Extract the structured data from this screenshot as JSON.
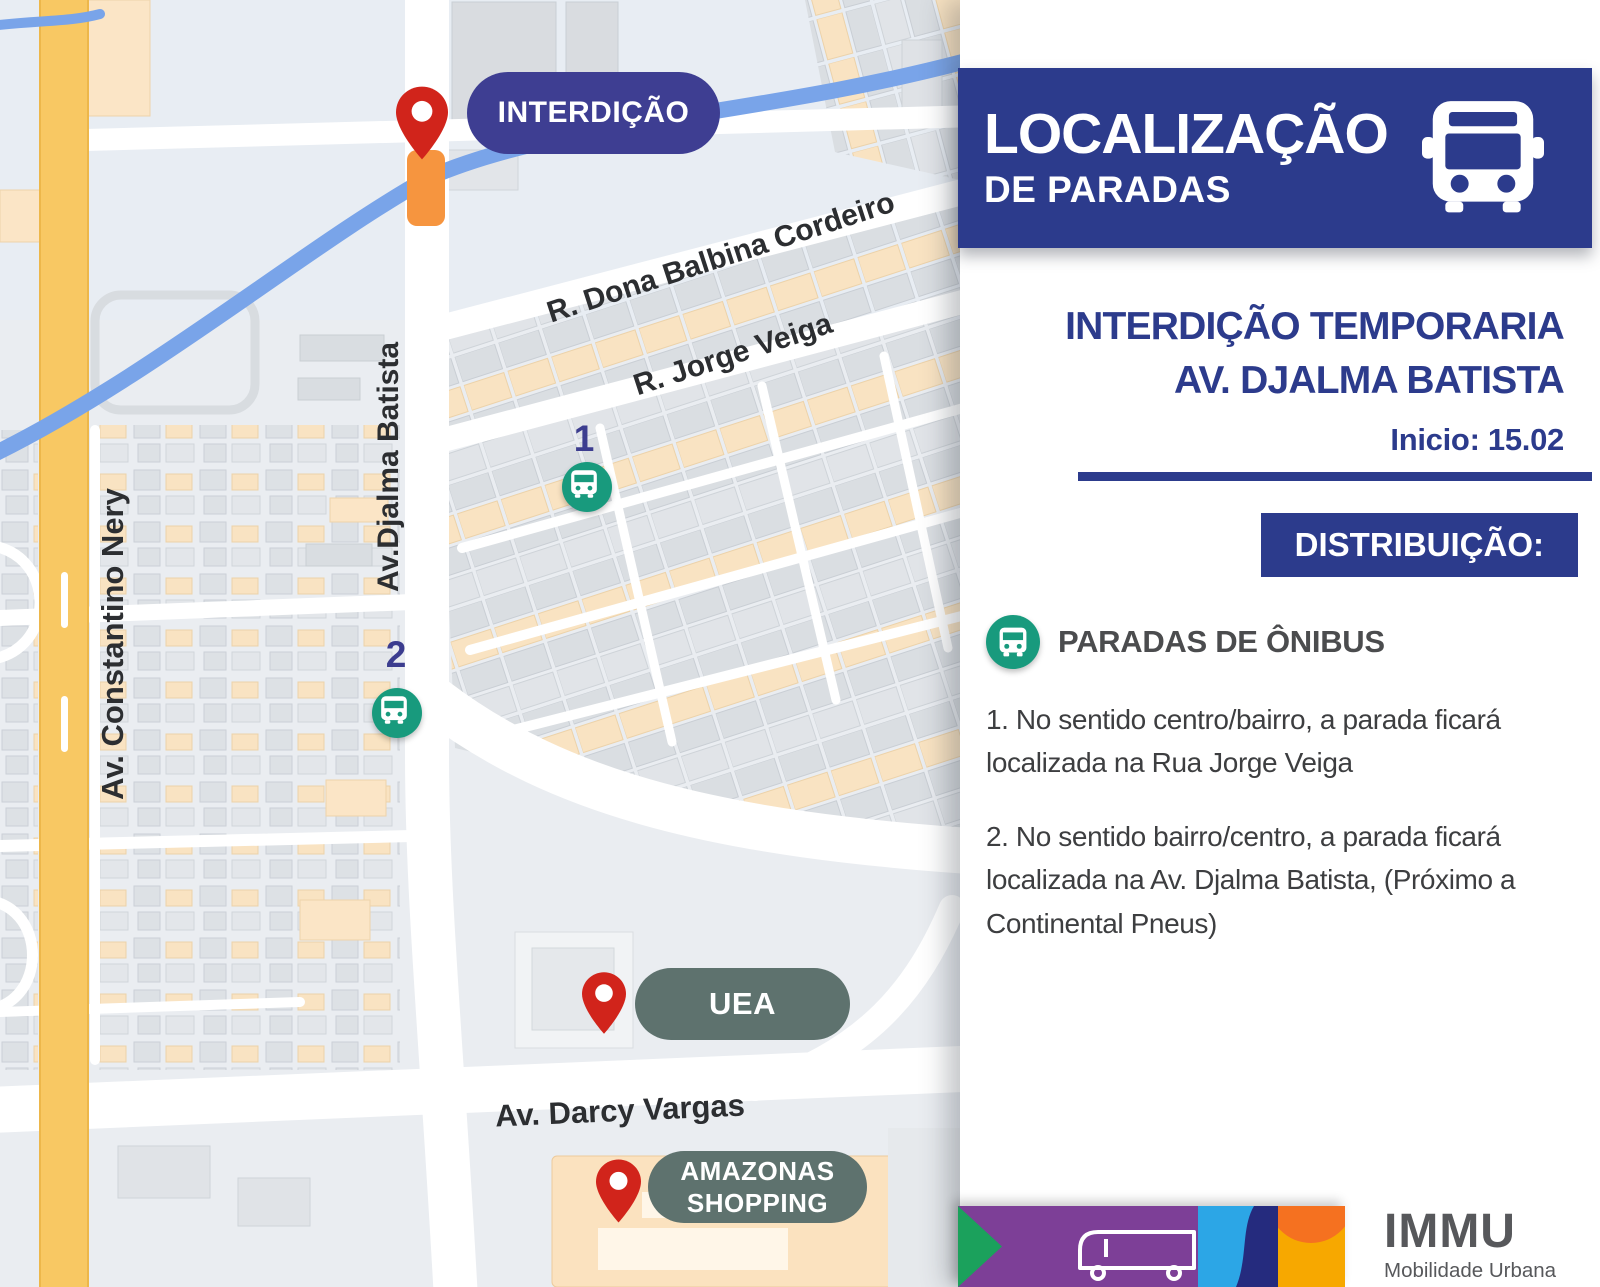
{
  "map": {
    "closure_badge": "INTERDIÇÃO",
    "streets": {
      "constantino": "Av. Constantino Nery",
      "djalma": "Av.Djalma Batista",
      "balbina": "R. Dona Balbina Cordeiro",
      "jorge": "R. Jorge Veiga",
      "darcy": "Av. Darcy Vargas"
    },
    "stops": [
      {
        "number": "1"
      },
      {
        "number": "2"
      }
    ],
    "poi": {
      "uea": "UEA",
      "shopping_line1": "AMAZONAS",
      "shopping_line2": "SHOPPING"
    }
  },
  "panel": {
    "banner": {
      "title": "LOCALIZAÇÃO",
      "subtitle": "DE PARADAS"
    },
    "heading": {
      "line1": "INTERDIÇÃO TEMPORARIA",
      "line2": "AV. DJALMA BATISTA",
      "start": "Inicio: 15.02"
    },
    "distribution_label": "DISTRIBUIÇÃO:",
    "legend_title": "PARADAS DE ÔNIBUS",
    "items": [
      "1. No sentido centro/bairro, a parada  ficará localizada na Rua Jorge Veiga",
      "2. No sentido bairro/centro, a parada ficará localizada na Av. Djalma Batista,  (Próximo a Continental Pneus)"
    ],
    "logo": {
      "name": "IMMU",
      "tagline": "Mobilidade Urbana"
    }
  },
  "colors": {
    "banner_blue": "#2c3b8c",
    "indigo_pill": "#3e3e92",
    "teal": "#189a7d",
    "slate_pill": "#5e726e",
    "pin_red": "#d1241b",
    "closure_orange": "#f6953f",
    "highway_yellow": "#f8c863",
    "river_blue": "#79a4e9",
    "strip_green": "#1ba15c",
    "strip_purple": "#7d3f97",
    "strip_lightblue": "#2ca6e6",
    "strip_navy": "#252b7e",
    "strip_yellow": "#f7a800",
    "strip_orange": "#f57120"
  }
}
